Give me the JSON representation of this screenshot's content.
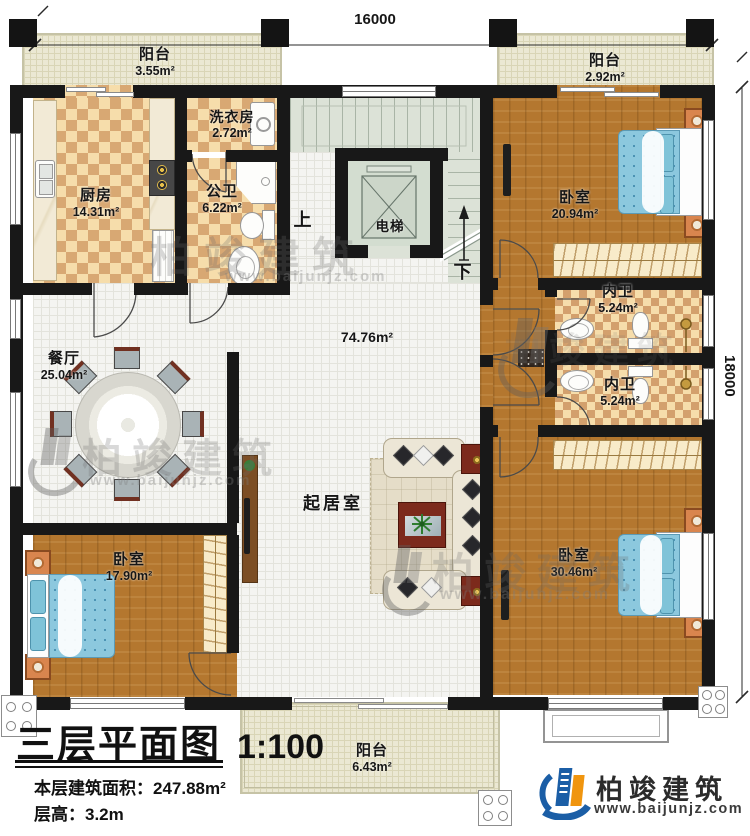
{
  "dimensions": {
    "top": "16000",
    "right": "18000"
  },
  "circulation": {
    "up": "上",
    "down": "下",
    "elevator": "电梯"
  },
  "rooms": [
    {
      "id": "balcony-top-left",
      "name": "阳台",
      "area": "3.55m²"
    },
    {
      "id": "balcony-top-right",
      "name": "阳台",
      "area": "2.92m²"
    },
    {
      "id": "kitchen",
      "name": "厨房",
      "area": "14.31m²"
    },
    {
      "id": "laundry",
      "name": "洗衣房",
      "area": "2.72m²"
    },
    {
      "id": "public-bath",
      "name": "公卫",
      "area": "6.22m²"
    },
    {
      "id": "bedroom-top-right",
      "name": "卧室",
      "area": "20.94m²"
    },
    {
      "id": "ensuite-top",
      "name": "内卫",
      "area": "5.24m²"
    },
    {
      "id": "ensuite-bottom",
      "name": "内卫",
      "area": "5.24m²"
    },
    {
      "id": "dining",
      "name": "餐厅",
      "area": "25.04m²"
    },
    {
      "id": "living-hall",
      "name": "起居室",
      "area": "74.76m²"
    },
    {
      "id": "bedroom-bottom-left",
      "name": "卧室",
      "area": "17.90m²"
    },
    {
      "id": "bedroom-bottom-right",
      "name": "卧室",
      "area": "30.46m²"
    },
    {
      "id": "balcony-bottom",
      "name": "阳台",
      "area": "6.43m²"
    }
  ],
  "title_block": {
    "title": "三层平面图",
    "scale": "1:100",
    "area_label": "本层建筑面积：",
    "area_value": "247.88m²",
    "height_label": "层高：",
    "height_value": "3.2m"
  },
  "brand": {
    "name": "柏竣建筑",
    "url": "www.baijunjz.com"
  },
  "watermark": {
    "name": "柏竣建筑",
    "url": "www.baijunjz.com"
  },
  "palette": {
    "wall": "#181818",
    "wood_floor": "#b4772f",
    "checker_light": "#f6ddab",
    "checker_dark": "#d8a873",
    "tile": "#f4f4f1",
    "balcony": "#ebe8d3",
    "stair": "#dce2d7",
    "bed_blue": "#8cc8de",
    "brand_blue": "#1b5ea6",
    "brand_orange": "#f0950f"
  }
}
